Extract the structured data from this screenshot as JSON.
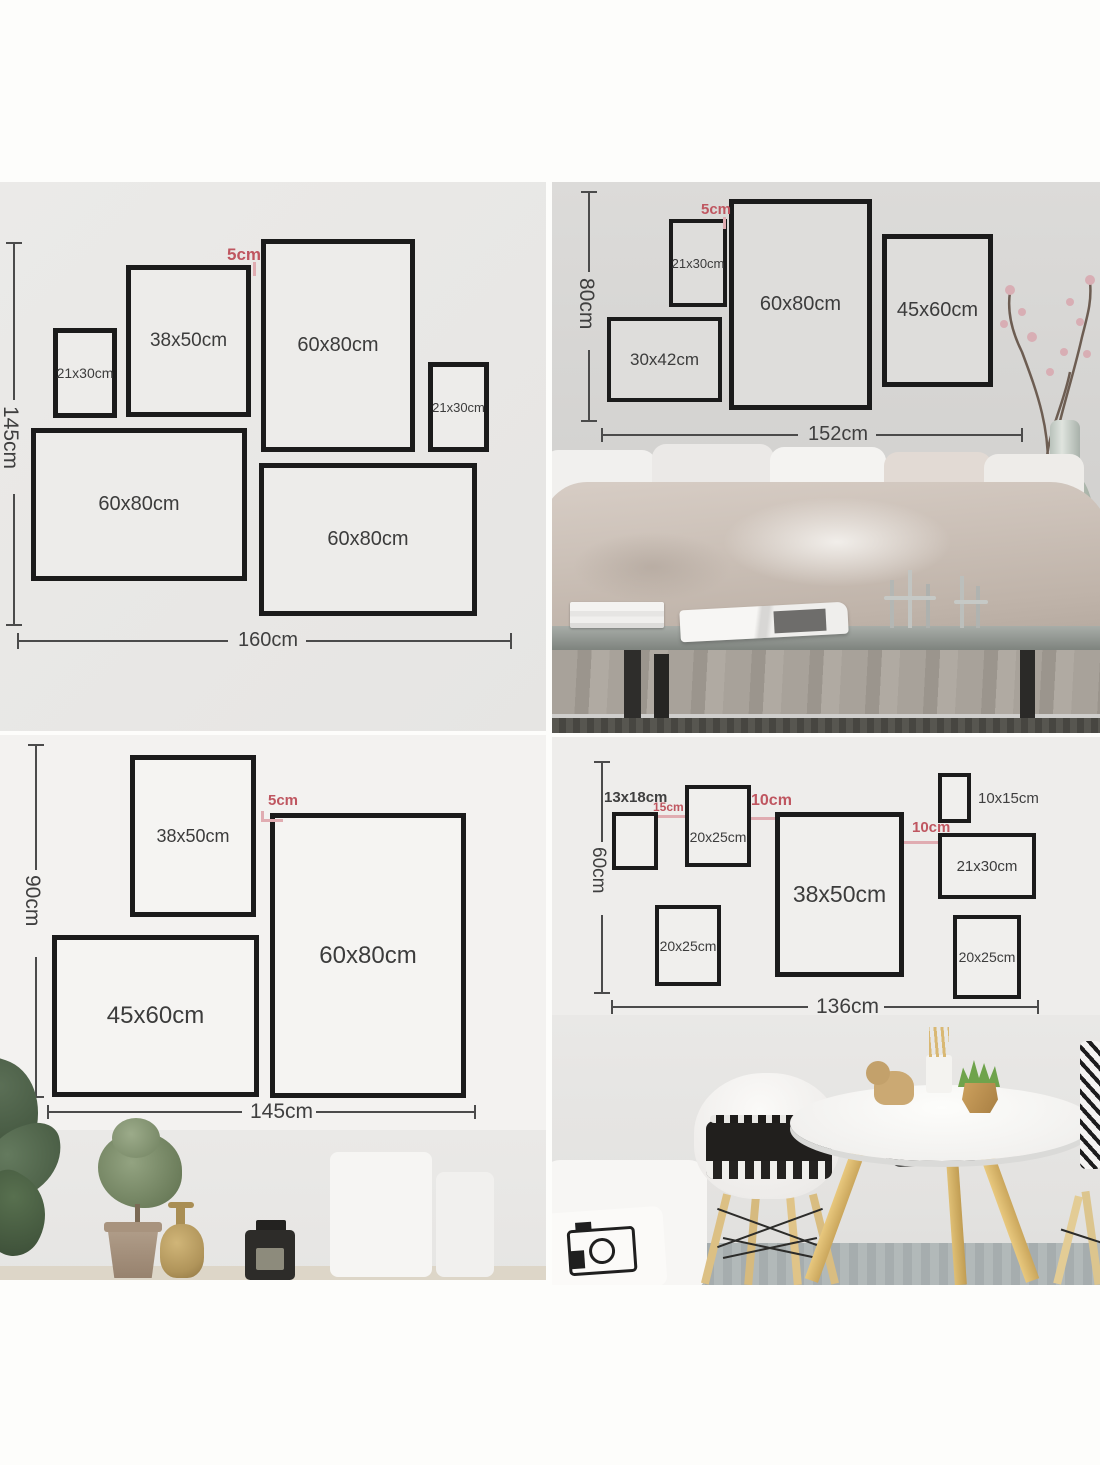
{
  "quadrants": {
    "top_left": {
      "gap_label": "5cm",
      "height_label": "145cm",
      "width_label": "160cm",
      "frames": [
        {
          "label": "21x30cm"
        },
        {
          "label": "38x50cm"
        },
        {
          "label": "60x80cm"
        },
        {
          "label": "21x30cm"
        },
        {
          "label": "60x80cm"
        },
        {
          "label": "60x80cm"
        }
      ]
    },
    "top_right": {
      "gap_label": "5cm",
      "height_label": "80cm",
      "width_label": "152cm",
      "frames": [
        {
          "label": "21x30cm"
        },
        {
          "label": "30x42cm"
        },
        {
          "label": "60x80cm"
        },
        {
          "label": "45x60cm"
        }
      ]
    },
    "bottom_left": {
      "gap_label": "5cm",
      "height_label": "90cm",
      "width_label": "145cm",
      "frames": [
        {
          "label": "38x50cm"
        },
        {
          "label": "60x80cm"
        },
        {
          "label": "45x60cm"
        }
      ]
    },
    "bottom_right": {
      "height_label": "60cm",
      "width_label": "136cm",
      "gap_labels": {
        "left": "15cm",
        "middle": "10cm",
        "right": "10cm"
      },
      "frames": [
        {
          "label": "13x18cm"
        },
        {
          "label": "20x25cm"
        },
        {
          "label": "38x50cm"
        },
        {
          "label": "10x15cm"
        },
        {
          "label": "21x30cm"
        },
        {
          "label": "20x25cm"
        },
        {
          "label": "20x25cm"
        }
      ]
    }
  },
  "colors": {
    "accent_red": "#bf5660",
    "frame_border": "#1b1b1b",
    "dimension_line": "#4b4b4b"
  }
}
